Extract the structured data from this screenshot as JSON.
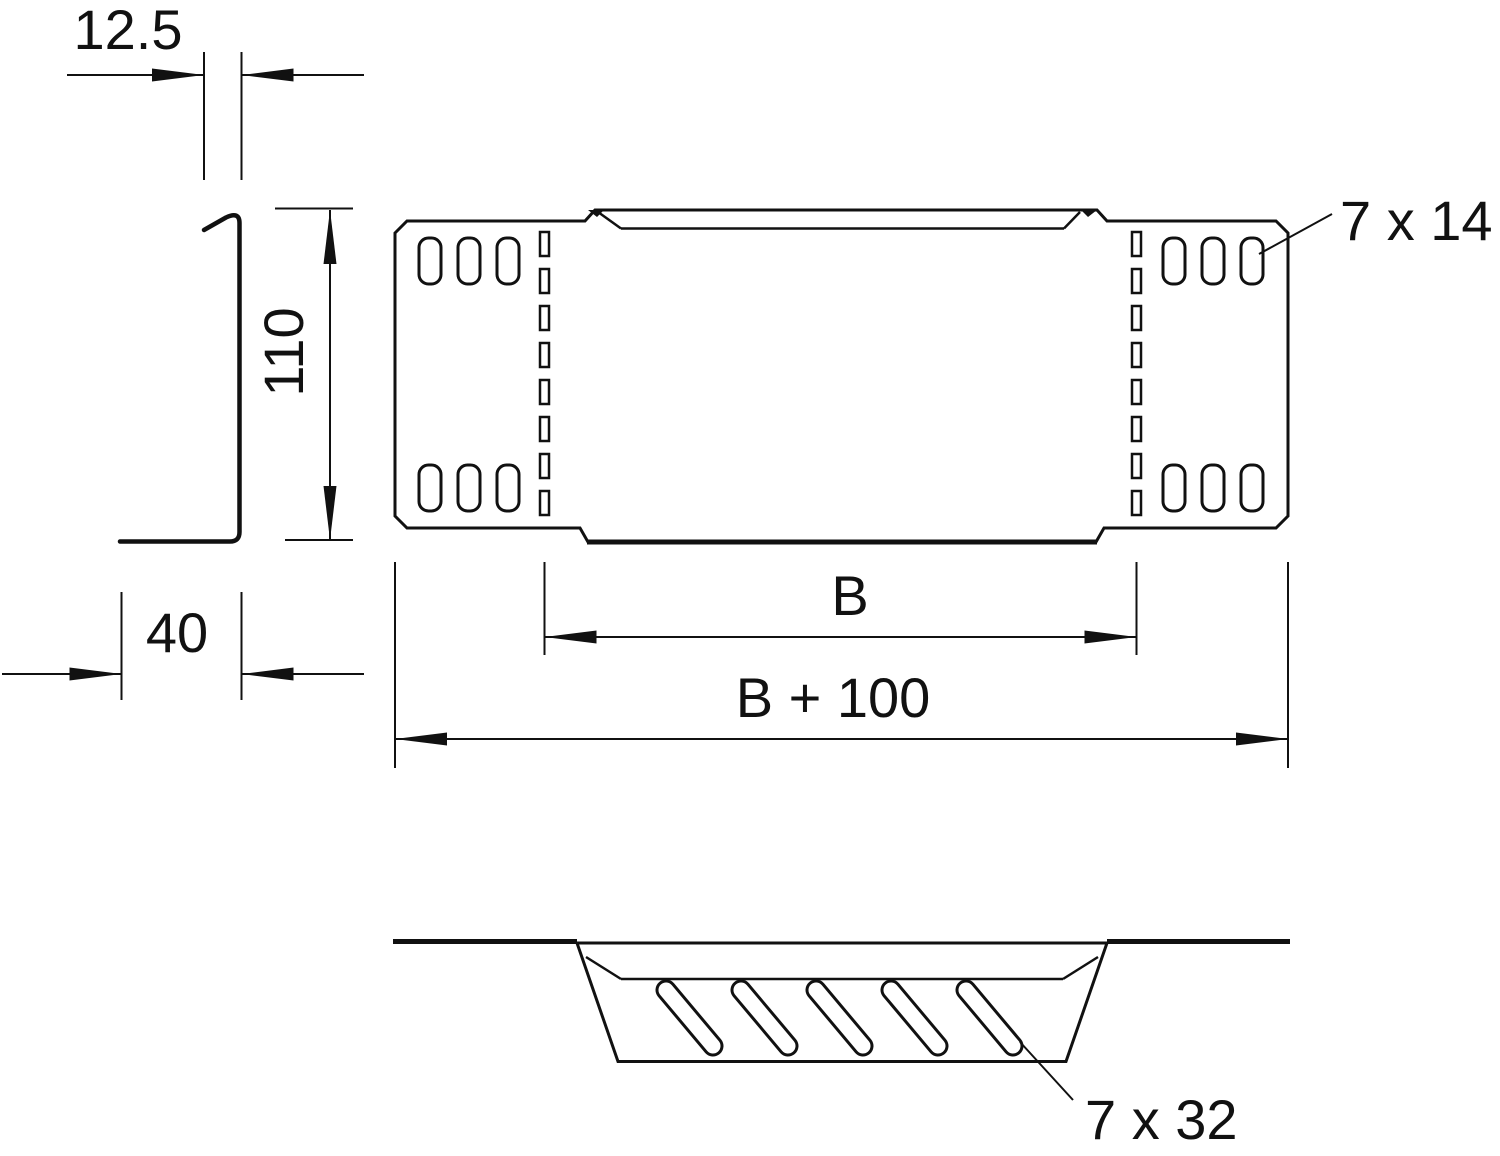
{
  "drawing": {
    "kind": "technical-dimension-drawing",
    "views": {
      "side_profile": "L-shaped sheet profile, left",
      "plan": "perforated end plate with slot rows, top right",
      "section": "bent tab with diagonal slots, bottom"
    },
    "labels": {
      "thickness": "12.5",
      "height": "110",
      "flange_width": "40",
      "inner_width": "B",
      "overall_width": "B + 100",
      "small_slot_size": "7 x 14",
      "large_slot_size": "7 x 32"
    },
    "counts": {
      "plan_corner_slots_per_group": 3,
      "plan_corner_slot_groups": 4,
      "perforation_rects_per_column": 8,
      "perforation_columns": 2,
      "diagonal_slots": 5
    },
    "colors": {
      "line": "#111111",
      "background": "#ffffff"
    }
  }
}
